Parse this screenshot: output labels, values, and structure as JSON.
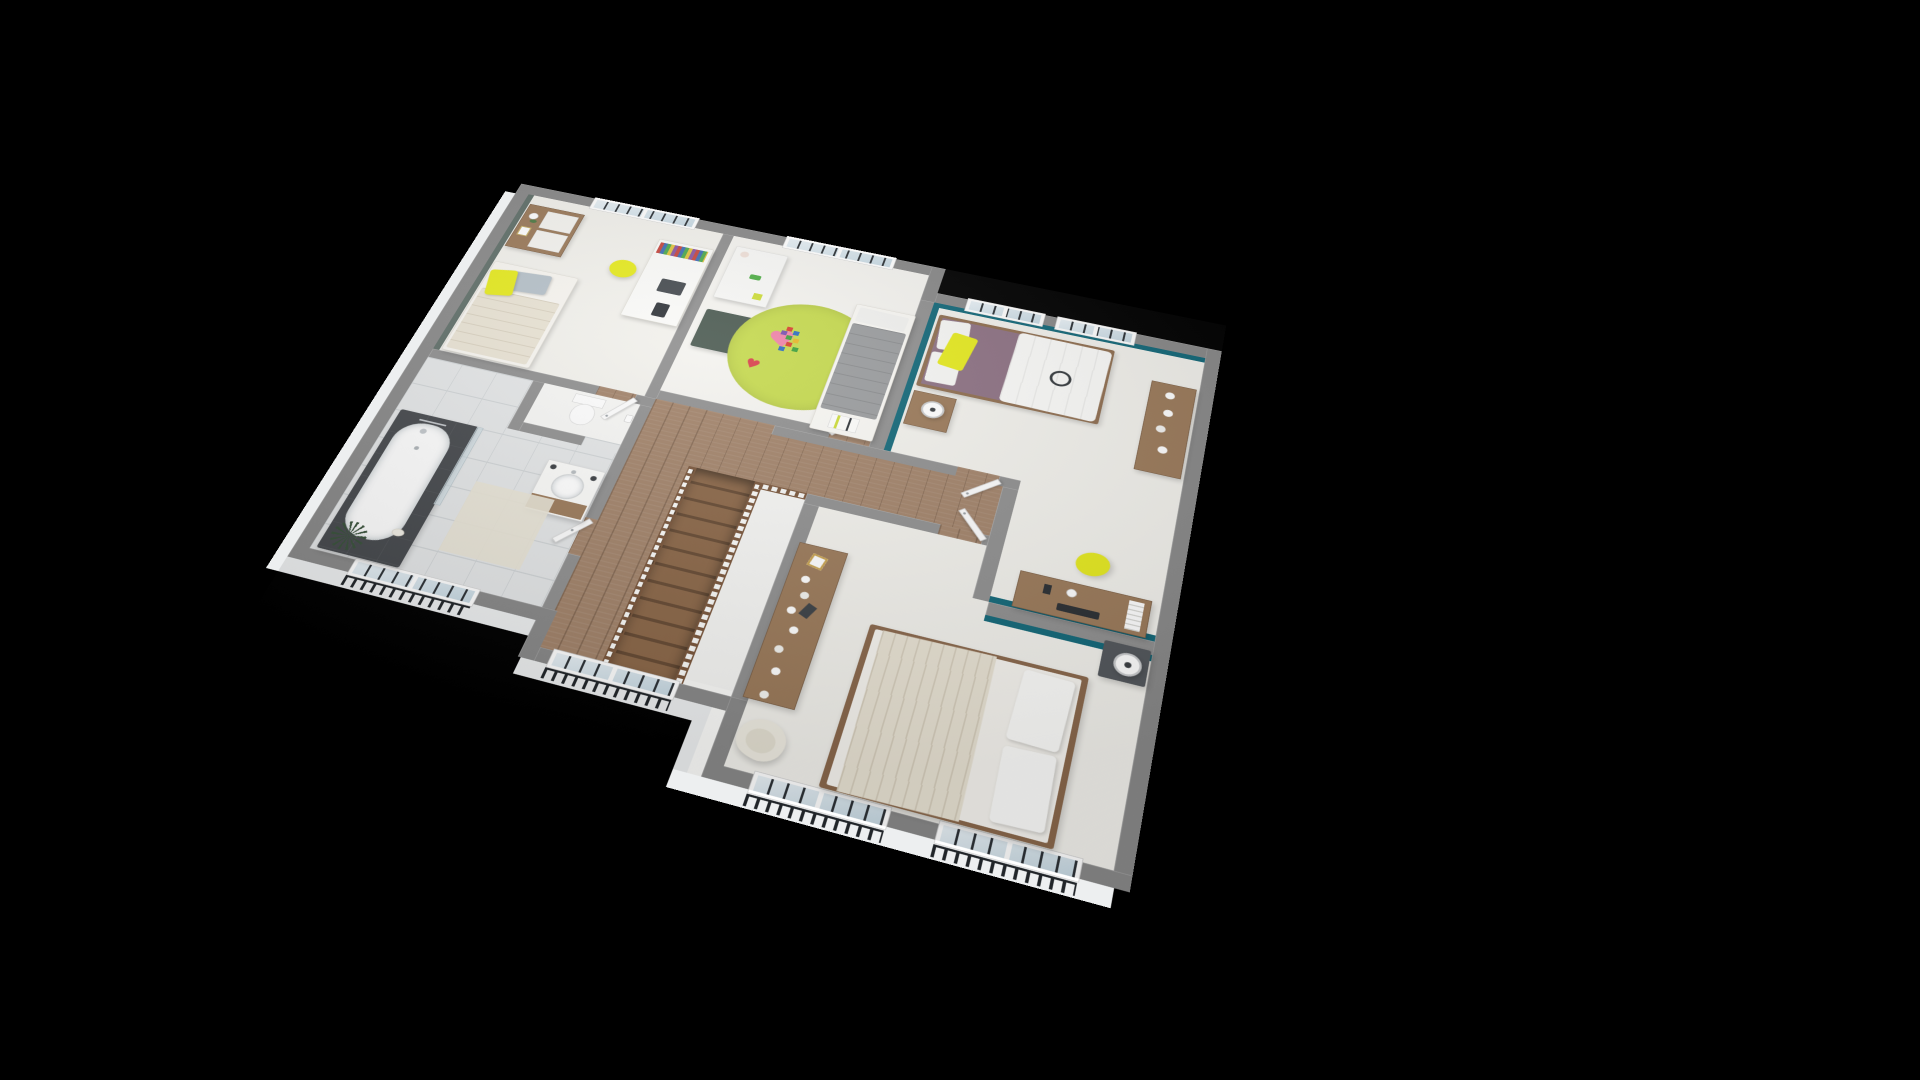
{
  "meta": {
    "type": "3d-isometric-floor-plan-render",
    "background": "black",
    "level": "upper-floor",
    "no_visible_text": true
  },
  "icons": {
    "heart": "♥"
  },
  "colors": {
    "background": "#000000",
    "ext-face": "#edeff0",
    "wall-cap": "#909090",
    "wall-cap-ext": "#898989",
    "floor-room": "#f2f1ec",
    "floor-kids": "#f4f3ef",
    "floor-void": "#f6f6f4",
    "floor-tile": "#e4e6e7",
    "tile-line": "#d0d4d6",
    "wood": "#a2836a",
    "stair-tread": "#8b6748",
    "stair-riser": "#664a33",
    "rail-wood": "#7a563b",
    "accent-teal": "#136879",
    "accent-sage": "#61706a",
    "accent-yellow": "#e6ea1f",
    "rug-green": "#c5d94e",
    "heart-pink": "#ef83a8",
    "heart-red": "#d8404b",
    "duvet-gray": "#9a9c9e",
    "duvet-cream": "#e9e3d4",
    "mauve": "#8d7183",
    "furn-wood": "#9b7a5a",
    "furn-wood-dark": "#7c5f45",
    "dark-green": "#4b5a51",
    "charcoal": "#46494d",
    "night-dark": "#53575c",
    "window-glass": "#d8e5ee",
    "muntin": "#2c3136",
    "railing-dark": "#212529",
    "door-white": "#fcfcfc",
    "plant-dark": "#38513a",
    "shadow": "rgba(0,0,0,0.18)"
  },
  "rooms": [
    {
      "id": "bedroom-1",
      "position": "top-left",
      "floor": "light-carpet",
      "accent_wall": "sage-green-left",
      "furniture": [
        "wood-dresser-white-drawers",
        "orchid-plant",
        "picture-frame",
        "single-bed-cream",
        "gray-pillow",
        "yellow-pillow",
        "white-desk",
        "row-of-books",
        "laptop",
        "tablet",
        "yellow-shell-chair"
      ],
      "windows": 1
    },
    {
      "id": "kids-bedroom",
      "position": "top-middle",
      "floor": "light-carpet",
      "furniture": [
        "white-cube-shelf",
        "plush-bunny",
        "green-toy-car",
        "dark-green-play-table",
        "yellow-kids-chair",
        "round-green-rug",
        "pink-hearts",
        "toy-block-tower",
        "single-bed-gray",
        "white-pillow",
        "sports-jersey"
      ],
      "windows": 1
    },
    {
      "id": "bedroom-2",
      "position": "right",
      "floor": "light-carpet",
      "accent_walls": [
        "teal-north",
        "teal-west"
      ],
      "furniture": [
        "double-bed-mauve-white",
        "white-pillows",
        "yellow-pillow",
        "headphones",
        "wood-nightstand",
        "table-lamp",
        "wood-console-shelf",
        "white-decor",
        "wood-desk",
        "monitor",
        "desk-books",
        "yellow-shell-chair"
      ],
      "windows": 2
    },
    {
      "id": "master-bedroom",
      "position": "bottom-right",
      "floor": "light-carpet",
      "accent_wall": "teal-north",
      "furniture": [
        "double-bed-wood-frame-cream",
        "white-pillows",
        "wood-sideboard",
        "vases-plates-decor",
        "gold-frame",
        "dark-nightstand",
        "white-cylinder-lamp",
        "cream-armchair"
      ],
      "windows": 2
    },
    {
      "id": "bathroom",
      "position": "left",
      "floor": "gray-tile",
      "furniture": [
        "bathtub-charcoal-surround",
        "shower-mixer",
        "glass-shower-screen",
        "soap-dish",
        "wall-hung-vanity",
        "round-basin",
        "soap-bottles",
        "bath-mat",
        "spiky-plant"
      ],
      "windows": 1
    },
    {
      "id": "wc",
      "position": "left-middle",
      "floor": "white",
      "furniture": [
        "toilet",
        "toilet-paper-holder"
      ],
      "windows": 0
    },
    {
      "id": "hallway-landing",
      "position": "center",
      "floor": "wood-planks",
      "features": [
        "straight-staircase-down",
        "wood-spindle-balustrade",
        "stair-void",
        "five-white-doors"
      ],
      "windows": 1
    }
  ],
  "stairs": {
    "flights": 1,
    "direction": "down-to-lower-floor",
    "treads": 12,
    "balustrade": "wood-spindles-both-sides"
  },
  "windows": {
    "total": 8,
    "with_guard_railing": 4,
    "style": "white-frame-dark-muntins"
  }
}
